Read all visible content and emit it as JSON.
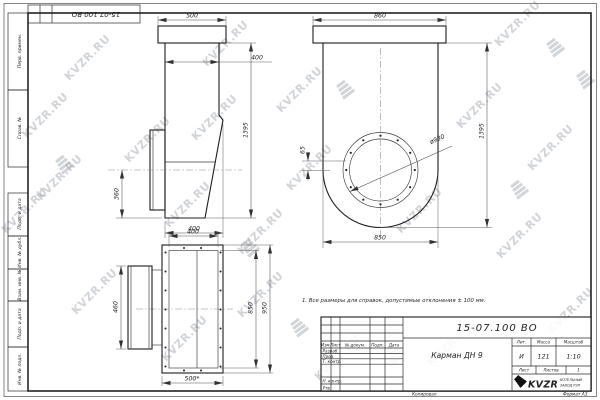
{
  "watermark": {
    "text": "KVZR.RU"
  },
  "corner_stamp": {
    "doc_number": "15-07.100 ВО"
  },
  "margin_labels": [
    "Перв. примен.",
    "Справ. №",
    "Подп. и дата",
    "Инв. № дубл.",
    "Взам. инв. №",
    "Подп. и дата",
    "Инв. № подл."
  ],
  "note": "1. Все размеры для справок, допустимые отклонения ± 100 мм.",
  "views": {
    "side": {
      "top_width": "500",
      "inner_width": "400",
      "side_offset": "360",
      "height": "1395",
      "bottom_width": "400"
    },
    "front": {
      "top_width": "860",
      "flange_diameter": "ø930",
      "offset": "65",
      "height": "1395",
      "bottom_width": "850"
    },
    "bottom": {
      "top_width": "400",
      "side_height": "460",
      "inner_length": "850",
      "outer_length": "950",
      "bottom_width": "500*"
    }
  },
  "title_block": {
    "doc_number": "15-07.100 ВО",
    "part_name": "Карман ДН 9",
    "header": {
      "izm": "Изм.",
      "list": "Лист",
      "doc": "№ докум.",
      "podp": "Подп.",
      "date": "Дата"
    },
    "roles": {
      "developed": "Разраб.",
      "checked": "Пров.",
      "tcontrol": "Т. контр.",
      "ncontrol": "Н. контр.",
      "approved": "Утв."
    },
    "lit_label": "Лит.",
    "lit": "И",
    "mass_label": "Масса",
    "mass": "121",
    "scale_label": "Масштаб",
    "scale": "1:10",
    "sheet_label": "Лист",
    "sheets_label": "Листов",
    "sheets_value": "1",
    "company": {
      "logo_text": "KVZR",
      "line1": "КОТЕЛЬНЫЙ",
      "line2": "ЗАВОД РЭП"
    },
    "copied": "Копировал",
    "format": "Формат А3"
  }
}
